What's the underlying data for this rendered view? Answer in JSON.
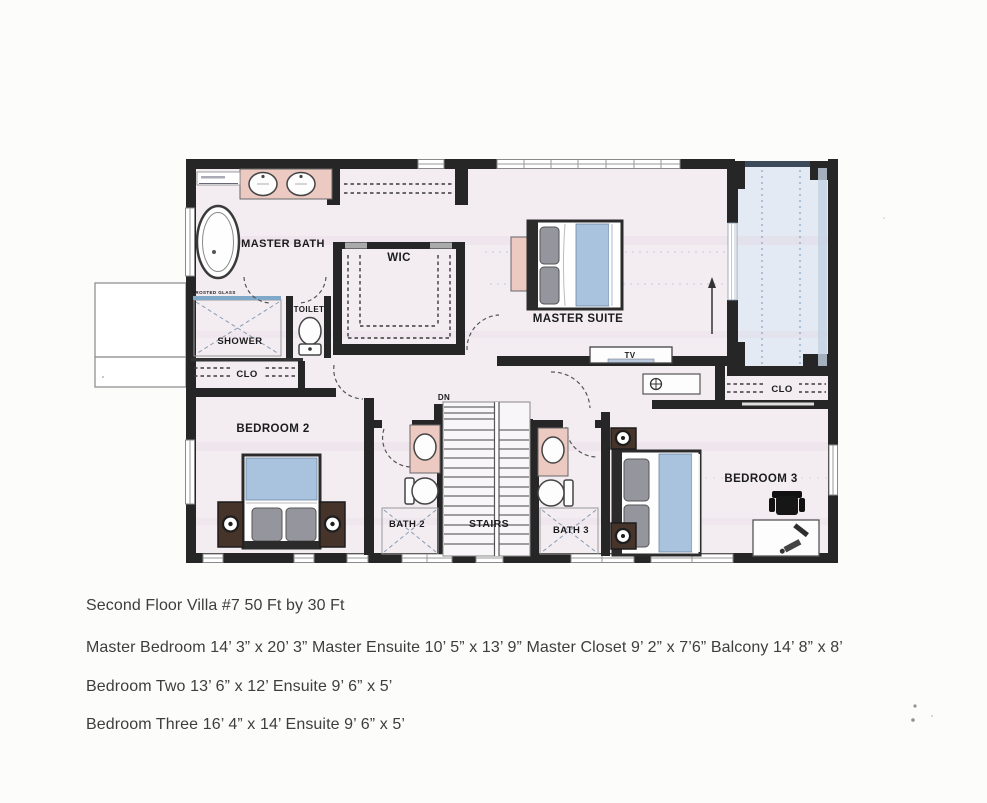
{
  "floor_plan": {
    "labels": {
      "master_bath": "MASTER BATH",
      "wic": "WIC",
      "toilet": "TOILET",
      "shower": "SHOWER",
      "closet2": "CLO",
      "master_suite": "MASTER SUITE",
      "tv": "TV",
      "dn": "DN",
      "bedroom2": "BEDROOM 2",
      "bath2": "BATH 2",
      "stairs": "STAIRS",
      "bath3": "BATH 3",
      "bedroom3": "BEDROOM 3",
      "closet3": "CLO",
      "glass_note": "FROSTED GLASS"
    },
    "colors": {
      "wall": "#262626",
      "floor": "#f3edf2",
      "balcony": "#e3eaf3",
      "fixture_pink": "#ecc9c1",
      "bed_blue": "#a9c3df",
      "pillow_gray": "#95959e",
      "nightstand_brown": "#46342a"
    }
  },
  "caption": {
    "line1": "Second Floor Villa #7 50 Ft by 30 Ft",
    "line2": "Master Bedroom 14’ 3” x 20’ 3” Master Ensuite 10’ 5” x 13’ 9” Master Closet 9’ 2” x 7’6” Balcony 14’ 8” x 8’",
    "line3": "Bedroom Two 13’ 6” x 12’ Ensuite 9’ 6” x 5’",
    "line4": "Bedroom Three 16’ 4” x 14’ Ensuite 9’ 6” x 5’"
  }
}
